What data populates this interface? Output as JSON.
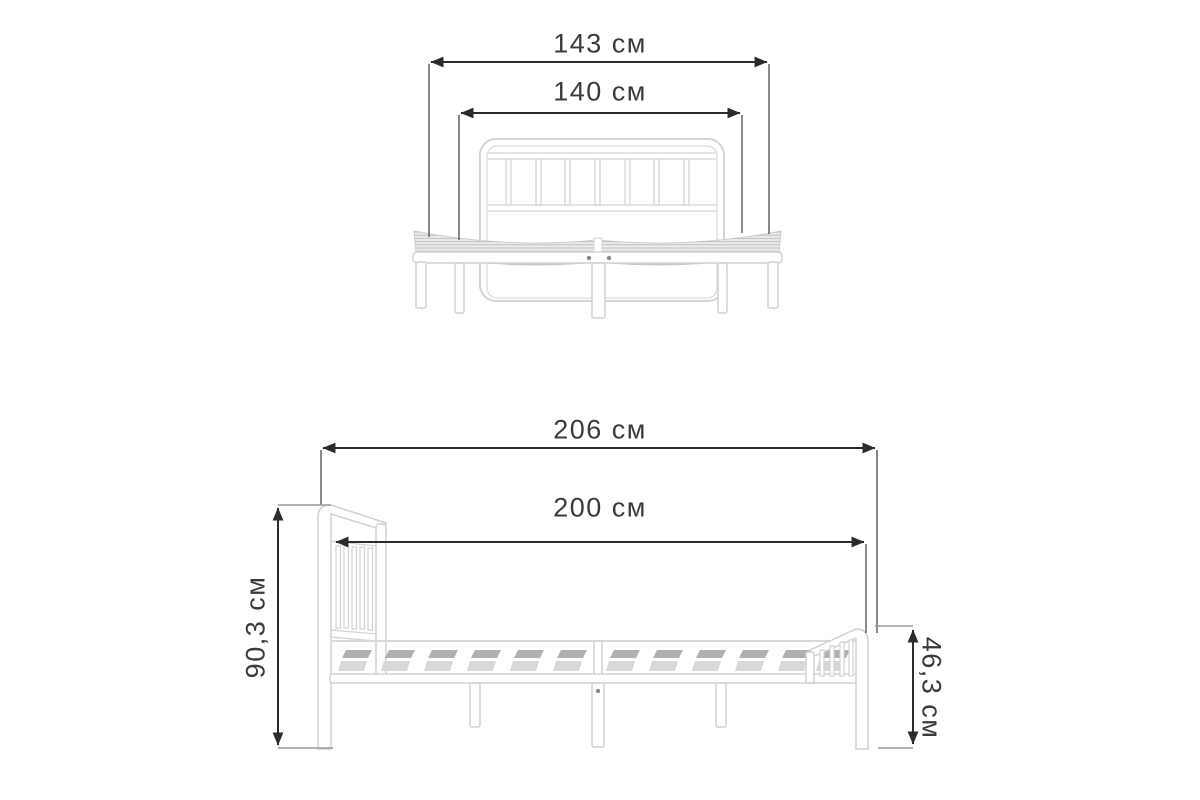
{
  "page": {
    "background": "#ffffff",
    "subject": "bed-frame-dimensions-diagram"
  },
  "dimensions": {
    "front_view": {
      "overall_width": "143 см",
      "mattress_width": "140 см"
    },
    "side_view": {
      "overall_length": "206 см",
      "mattress_length": "200 см",
      "headboard_height": "90,3 см",
      "footboard_height": "46,3 см"
    }
  },
  "colors": {
    "dimension_line": "#2b2b2b",
    "extension_line": "#4a4a4a",
    "tick_line": "#9a9a9a",
    "label_text": "#3a3a3a",
    "frame_stroke": "#d4d4d4",
    "frame_fill": "#ffffff",
    "mesh_fill": "#ececec",
    "mesh_stripe": "#b9b9b9",
    "slat_dark": "#b0b0b0",
    "slat_light": "#d8d8d8",
    "screw_dot": "#8a8a8a"
  }
}
